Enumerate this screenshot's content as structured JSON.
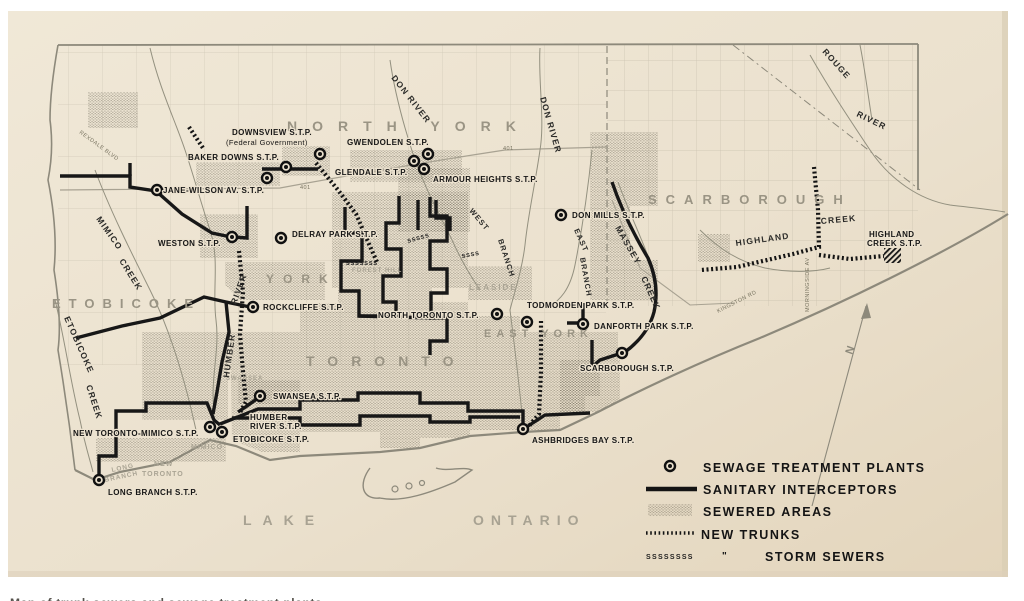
{
  "boroughs": {
    "north_york": "NORTH YORK",
    "scarborough": "SCARBOROUGH",
    "etobicoke": "ETOBICOKE",
    "york": "YORK",
    "toronto": "TORONTO",
    "east_york": "EAST YORK"
  },
  "towns": {
    "leaside": "LEASIDE",
    "forest_hill": "FOREST HILL",
    "swansea": "SWANSEA",
    "mimico": "MIMICO",
    "new_toronto_1": "NEW",
    "new_toronto_2": "TORONTO",
    "long_branch_1": "LONG",
    "long_branch_2": "BRANCH"
  },
  "lake": {
    "word1": "LAKE",
    "word2": "ONTARIO"
  },
  "waterways": {
    "don_w": "DON RIVER",
    "don_e": "DON RIVER",
    "rouge_1": "ROUGE",
    "rouge_2": "RIVER",
    "humber_1": "HUMBER",
    "humber_2": "RIVER",
    "mimico_1": "MIMICO",
    "mimico_2": "CREEK",
    "etobicoke_1": "ETOBICOKE",
    "etobicoke_2": "CREEK",
    "massey_1": "MASSEY",
    "massey_2": "CREEK",
    "highland_1": "HIGHLAND",
    "highland_2": "CREEK",
    "west_branch_1": "WEST",
    "west_branch_2": "BRANCH",
    "east_branch_1": "EAST",
    "east_branch_2": "BRANCH"
  },
  "roads": {
    "rexdale": "REXDALE BLVD",
    "hwy401_a": "401",
    "hwy401_b": "401",
    "kingston": "KINGSTON RD",
    "morningside": "MORNINGSIDE AV"
  },
  "plants": {
    "downsview_1": "DOWNSVIEW S.T.P.",
    "downsview_2": "(Federal Government)",
    "baker_downs": "BAKER DOWNS S.T.P.",
    "gwendolen": "GWENDOLEN S.T.P.",
    "glendale": "GLENDALE S.T.P.",
    "armour_heights": "ARMOUR HEIGHTS S.T.P.",
    "jane_wilson": "JANE-WILSON AV. S.T.P.",
    "weston": "WESTON S.T.P.",
    "delray_park": "DELRAY PARK S.T.P.",
    "don_mills": "DON MILLS S.T.P.",
    "rockcliffe": "ROCKCLIFFE S.T.P.",
    "north_toronto": "NORTH TORONTO S.T.P.",
    "todmorden_park": "TODMORDEN PARK S.T.P.",
    "danforth_park": "DANFORTH PARK S.T.P.",
    "scarborough": "SCARBOROUGH S.T.P.",
    "highland_creek_1": "HIGHLAND",
    "highland_creek_2": "CREEK S.T.P.",
    "swansea": "SWANSEA S.T.P.",
    "humber_river_1": "HUMBER",
    "humber_river_2": "RIVER S.T.P.",
    "new_toronto_mimico": "NEW TORONTO-MIMICO S.T.P.",
    "etobicoke": "ETOBICOKE S.T.P.",
    "long_branch": "LONG BRANCH S.T.P.",
    "ashbridges_bay": "ASHBRIDGES BAY S.T.P."
  },
  "storm": {
    "run_long": "SSSSSSS",
    "run_mid": "SSSSS",
    "run_short": "SSSS",
    "legend_pattern": "SSSSSSSS",
    "ditto": "\""
  },
  "legend": {
    "sewage_plants": "SEWAGE TREATMENT PLANTS",
    "sanitary_interceptors": "SANITARY INTERCEPTORS",
    "sewered_areas": "SEWERED AREAS",
    "new_trunks": "NEW TRUNKS",
    "storm_sewers": "STORM SEWERS"
  },
  "compass": {
    "label": "N"
  },
  "footer": {
    "caption_cropped": "Map of trunk sewers and sewage treatment plants"
  },
  "colors": {
    "paper": "#ebe1ce",
    "ink": "#171717",
    "map_gray": "#8d897b",
    "sewered_shade": "#4a4537"
  }
}
